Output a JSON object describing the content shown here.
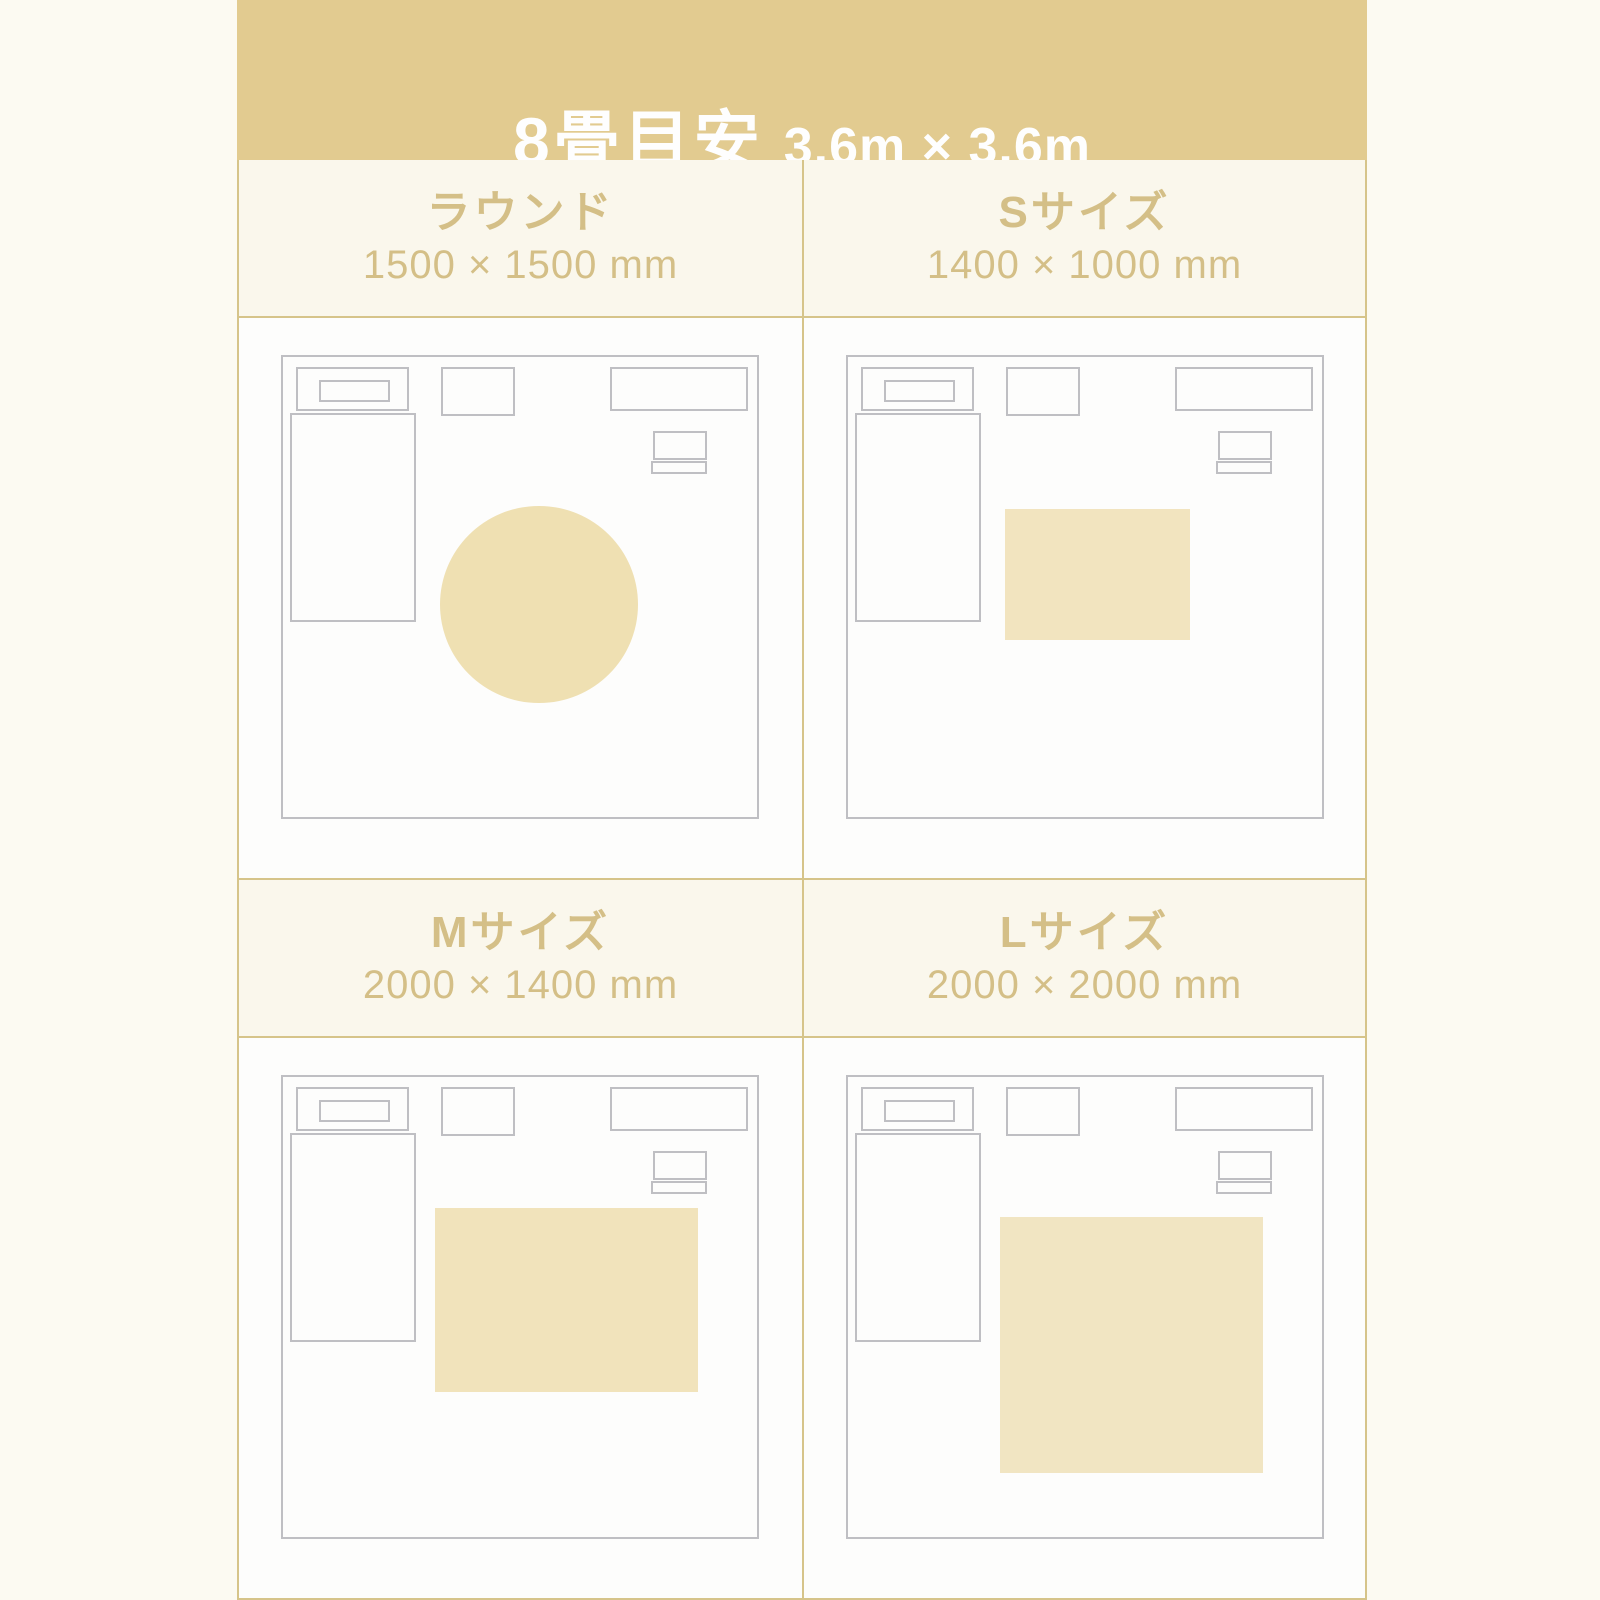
{
  "header": {
    "title": "8畳目安",
    "room_size": "3.6m × 3.6m"
  },
  "panels": [
    {
      "label": "ラウンド",
      "dimensions": "1500 × 1500 mm",
      "rug": {
        "shape": "circle",
        "left_pct": 33.2,
        "top_pct": 32.4,
        "width_pct": 41.7,
        "height_pct": 42.9,
        "color": "#efe0b2"
      }
    },
    {
      "label": "Sサイズ",
      "dimensions": "1400 × 1000 mm",
      "rug": {
        "shape": "rect",
        "left_pct": 33.2,
        "top_pct": 33.0,
        "width_pct": 38.9,
        "height_pct": 28.6,
        "color": "#f2e4bf"
      }
    },
    {
      "label": "Mサイズ",
      "dimensions": "2000 × 1400 mm",
      "rug": {
        "shape": "rect",
        "left_pct": 32.0,
        "top_pct": 28.5,
        "width_pct": 55.6,
        "height_pct": 40.0,
        "color": "#f1e3bb"
      }
    },
    {
      "label": "Lサイズ",
      "dimensions": "2000 × 2000 mm",
      "rug": {
        "shape": "rect",
        "left_pct": 32.0,
        "top_pct": 30.5,
        "width_pct": 55.6,
        "height_pct": 55.5,
        "color": "#f1e5c2"
      }
    }
  ],
  "colors": {
    "page_background": "#fcfaf2",
    "band_background": "#e2cb90",
    "band_text": "#fefefe",
    "panel_header_background": "#faf7ec",
    "accent_text": "#d4bf87",
    "grid_border": "#d6c48a",
    "diagram_background": "#fdfdfc",
    "furniture_outline": "#bfbfc3"
  }
}
